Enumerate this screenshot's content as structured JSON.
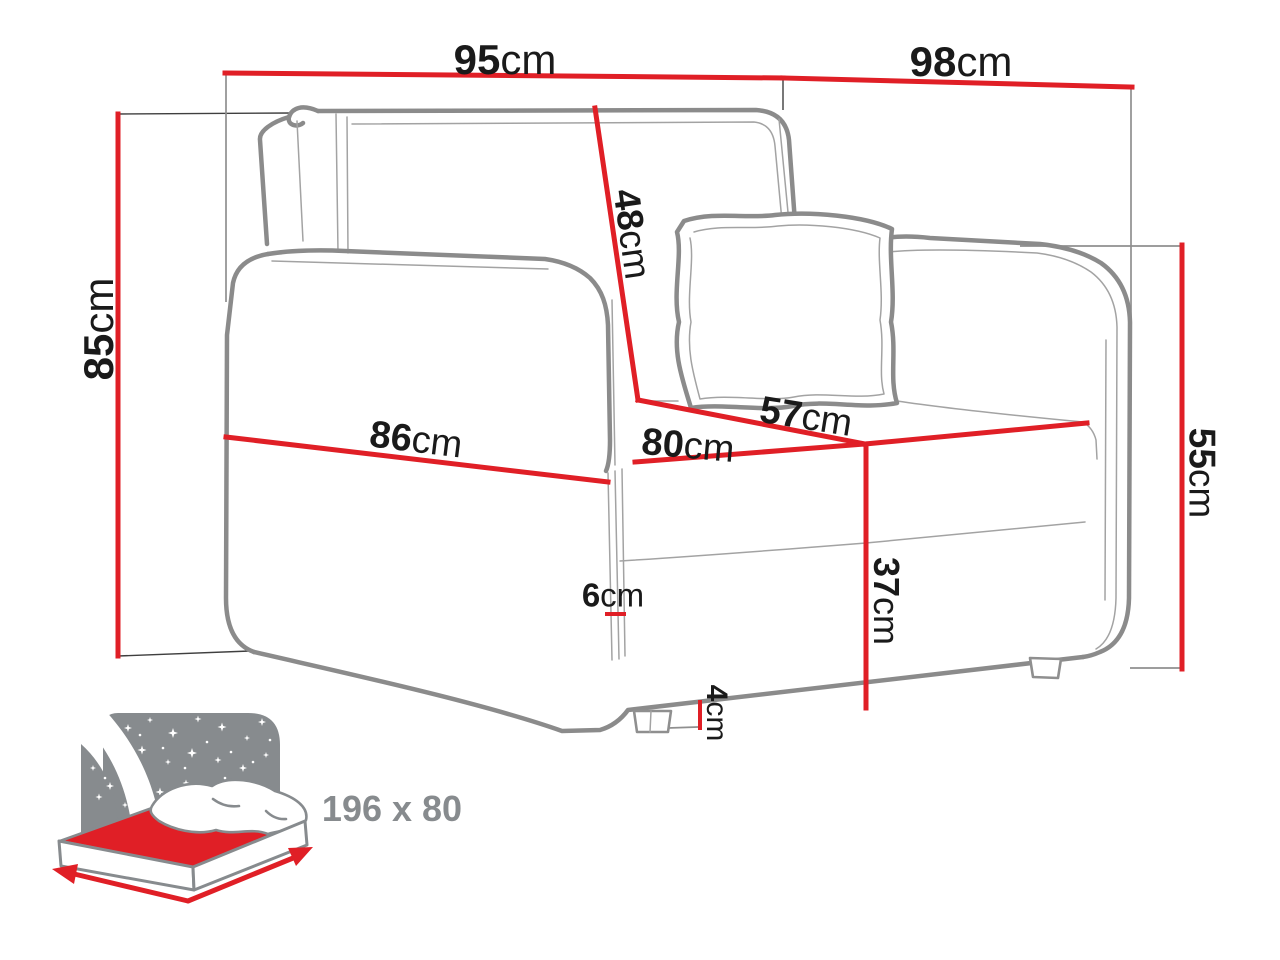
{
  "title": "Sofa bed dimension diagram",
  "dimensions": {
    "width_top": {
      "value": "95",
      "unit": "cm",
      "meaning": "overall width (front)"
    },
    "depth_top": {
      "value": "98",
      "unit": "cm",
      "meaning": "overall depth (top)"
    },
    "height_total": {
      "value": "85",
      "unit": "cm",
      "meaning": "overall height"
    },
    "backrest": {
      "value": "48",
      "unit": "cm",
      "meaning": "backrest height"
    },
    "seat_depth": {
      "value": "57",
      "unit": "cm",
      "meaning": "seat depth"
    },
    "seat_width": {
      "value": "80",
      "unit": "cm",
      "meaning": "seat width"
    },
    "arm_front": {
      "value": "86",
      "unit": "cm",
      "meaning": "width across armrest front"
    },
    "seat_height": {
      "value": "37",
      "unit": "cm",
      "meaning": "seat height"
    },
    "arm_side": {
      "value": "6",
      "unit": "cm",
      "meaning": "armrest thickness"
    },
    "leg": {
      "value": "4",
      "unit": "cm",
      "meaning": "leg height"
    },
    "arm_height": {
      "value": "55",
      "unit": "cm",
      "meaning": "armrest height"
    }
  },
  "sleeping_area": {
    "label": "196 x 80"
  },
  "colors": {
    "red": "#e01f26",
    "gray": "#8b8b8b",
    "ink": "#1a1a1a",
    "icon": "#878b8e"
  },
  "icons": [
    {
      "name": "sleeping-function-icon",
      "description": "bed with starry night panel"
    }
  ]
}
